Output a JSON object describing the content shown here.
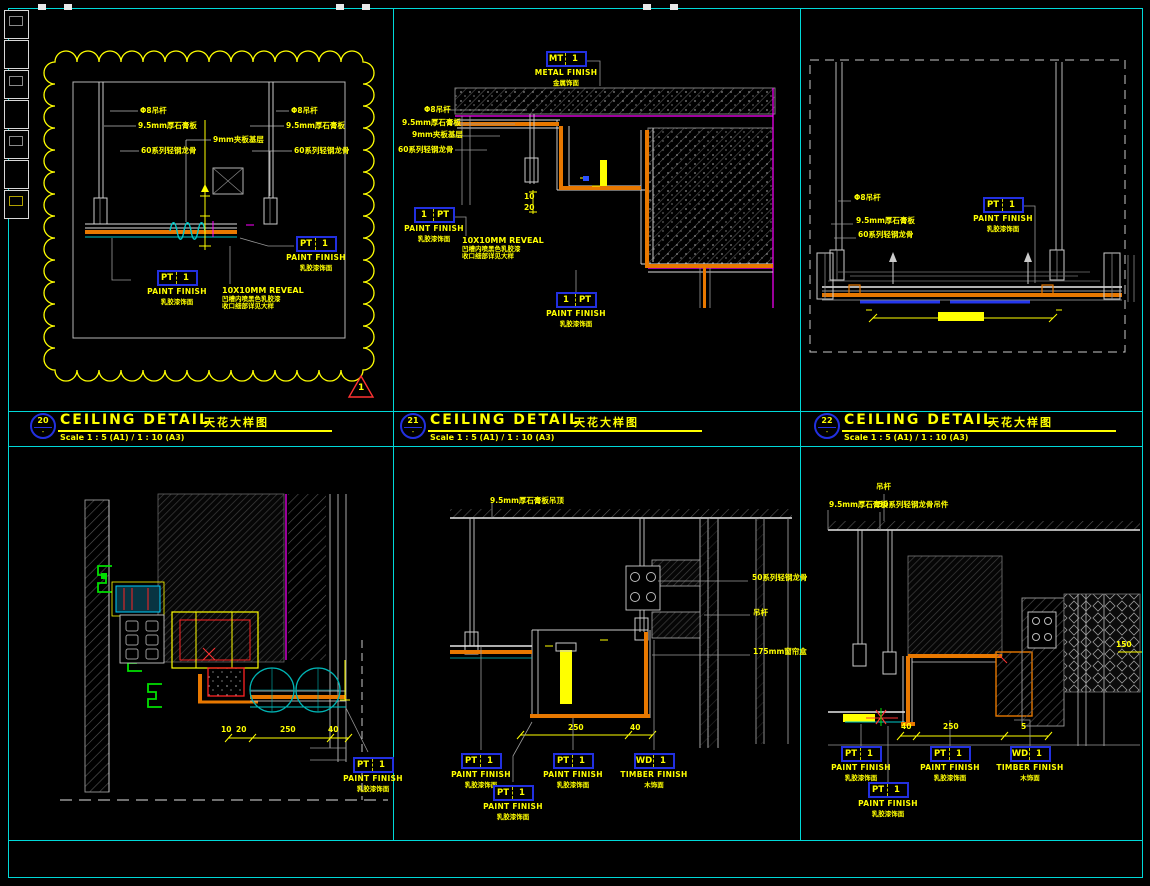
{
  "sheet": {
    "bg": "#000000",
    "frame_color": "#00d9d9",
    "accent_yellow": "#ffff00",
    "accent_orange": "#e87800",
    "accent_magenta": "#ff00ff",
    "tag_blue": "#2230e0"
  },
  "titles": [
    {
      "num": "20",
      "name": "CEILING DETAIL",
      "cn": "天花大样图",
      "scale": "Scale 1 : 5 (A1) / 1 : 10 (A3)"
    },
    {
      "num": "21",
      "name": "CEILING DETAIL",
      "cn": "天花大样图",
      "scale": "Scale 1 : 5 (A1) / 1 : 10 (A3)"
    },
    {
      "num": "22",
      "name": "CEILING DETAIL",
      "cn": "天花大样图",
      "scale": "Scale 1 : 5 (A1) / 1 : 10 (A3)"
    }
  ],
  "tags": {
    "pt": {
      "code": "PT",
      "num": "1",
      "name": "PAINT FINISH",
      "cn": "乳胶漆饰面"
    },
    "pt_rev": {
      "code": "1",
      "num": "PT",
      "name": "PAINT FINISH",
      "cn": "乳胶漆饰面"
    },
    "mt": {
      "code": "MT",
      "num": "1",
      "name": "METAL FINISH",
      "cn": "金属饰面"
    },
    "wd": {
      "code": "WD",
      "num": "1",
      "name": "TIMBER FINISH",
      "cn": "木饰面"
    }
  },
  "p1": {
    "rev_num": "1",
    "labels": {
      "rod": "Φ8吊杆",
      "gyp": "9.5mm厚石膏板",
      "ply": "9mm夹板基层",
      "keel": "60系列轻钢龙骨",
      "reveal": "10X10MM REVEAL",
      "reveal_l1": "凹槽内喷黑色乳胶漆",
      "reveal_l2": "收口细部详见大样"
    }
  },
  "p2": {
    "labels": {
      "rod": "Φ8吊杆",
      "gyp": "9.5mm厚石膏板",
      "ply": "9mm夹板基层",
      "keel": "60系列轻钢龙骨",
      "reveal": "10X10MM REVEAL",
      "reveal_l1": "凹槽内喷黑色乳胶漆",
      "reveal_l2": "收口细部详见大样"
    },
    "dims": {
      "a": "10",
      "b": "20"
    }
  },
  "p3": {
    "labels": {
      "rod": "Φ8吊杆",
      "gyp": "9.5mm厚石膏板",
      "keel": "60系列轻钢龙骨"
    }
  },
  "p4": {
    "dims": {
      "a": "10",
      "b": "20",
      "c": "250",
      "d": "40"
    }
  },
  "p5": {
    "labels": {
      "top": "9.5mm厚石膏板吊顶",
      "r1": "50系列轻钢龙骨",
      "r2": "吊杆",
      "r3": "175mm窗帘盒"
    },
    "dims": {
      "a": "250",
      "b": "40"
    }
  },
  "p6": {
    "labels": {
      "rod": "吊杆",
      "gyp": "9.5mm厚石膏板",
      "keel": "50系列轻钢龙骨吊件",
      "right": "150"
    },
    "dims": {
      "a": "40",
      "b": "250",
      "c": "5"
    }
  }
}
